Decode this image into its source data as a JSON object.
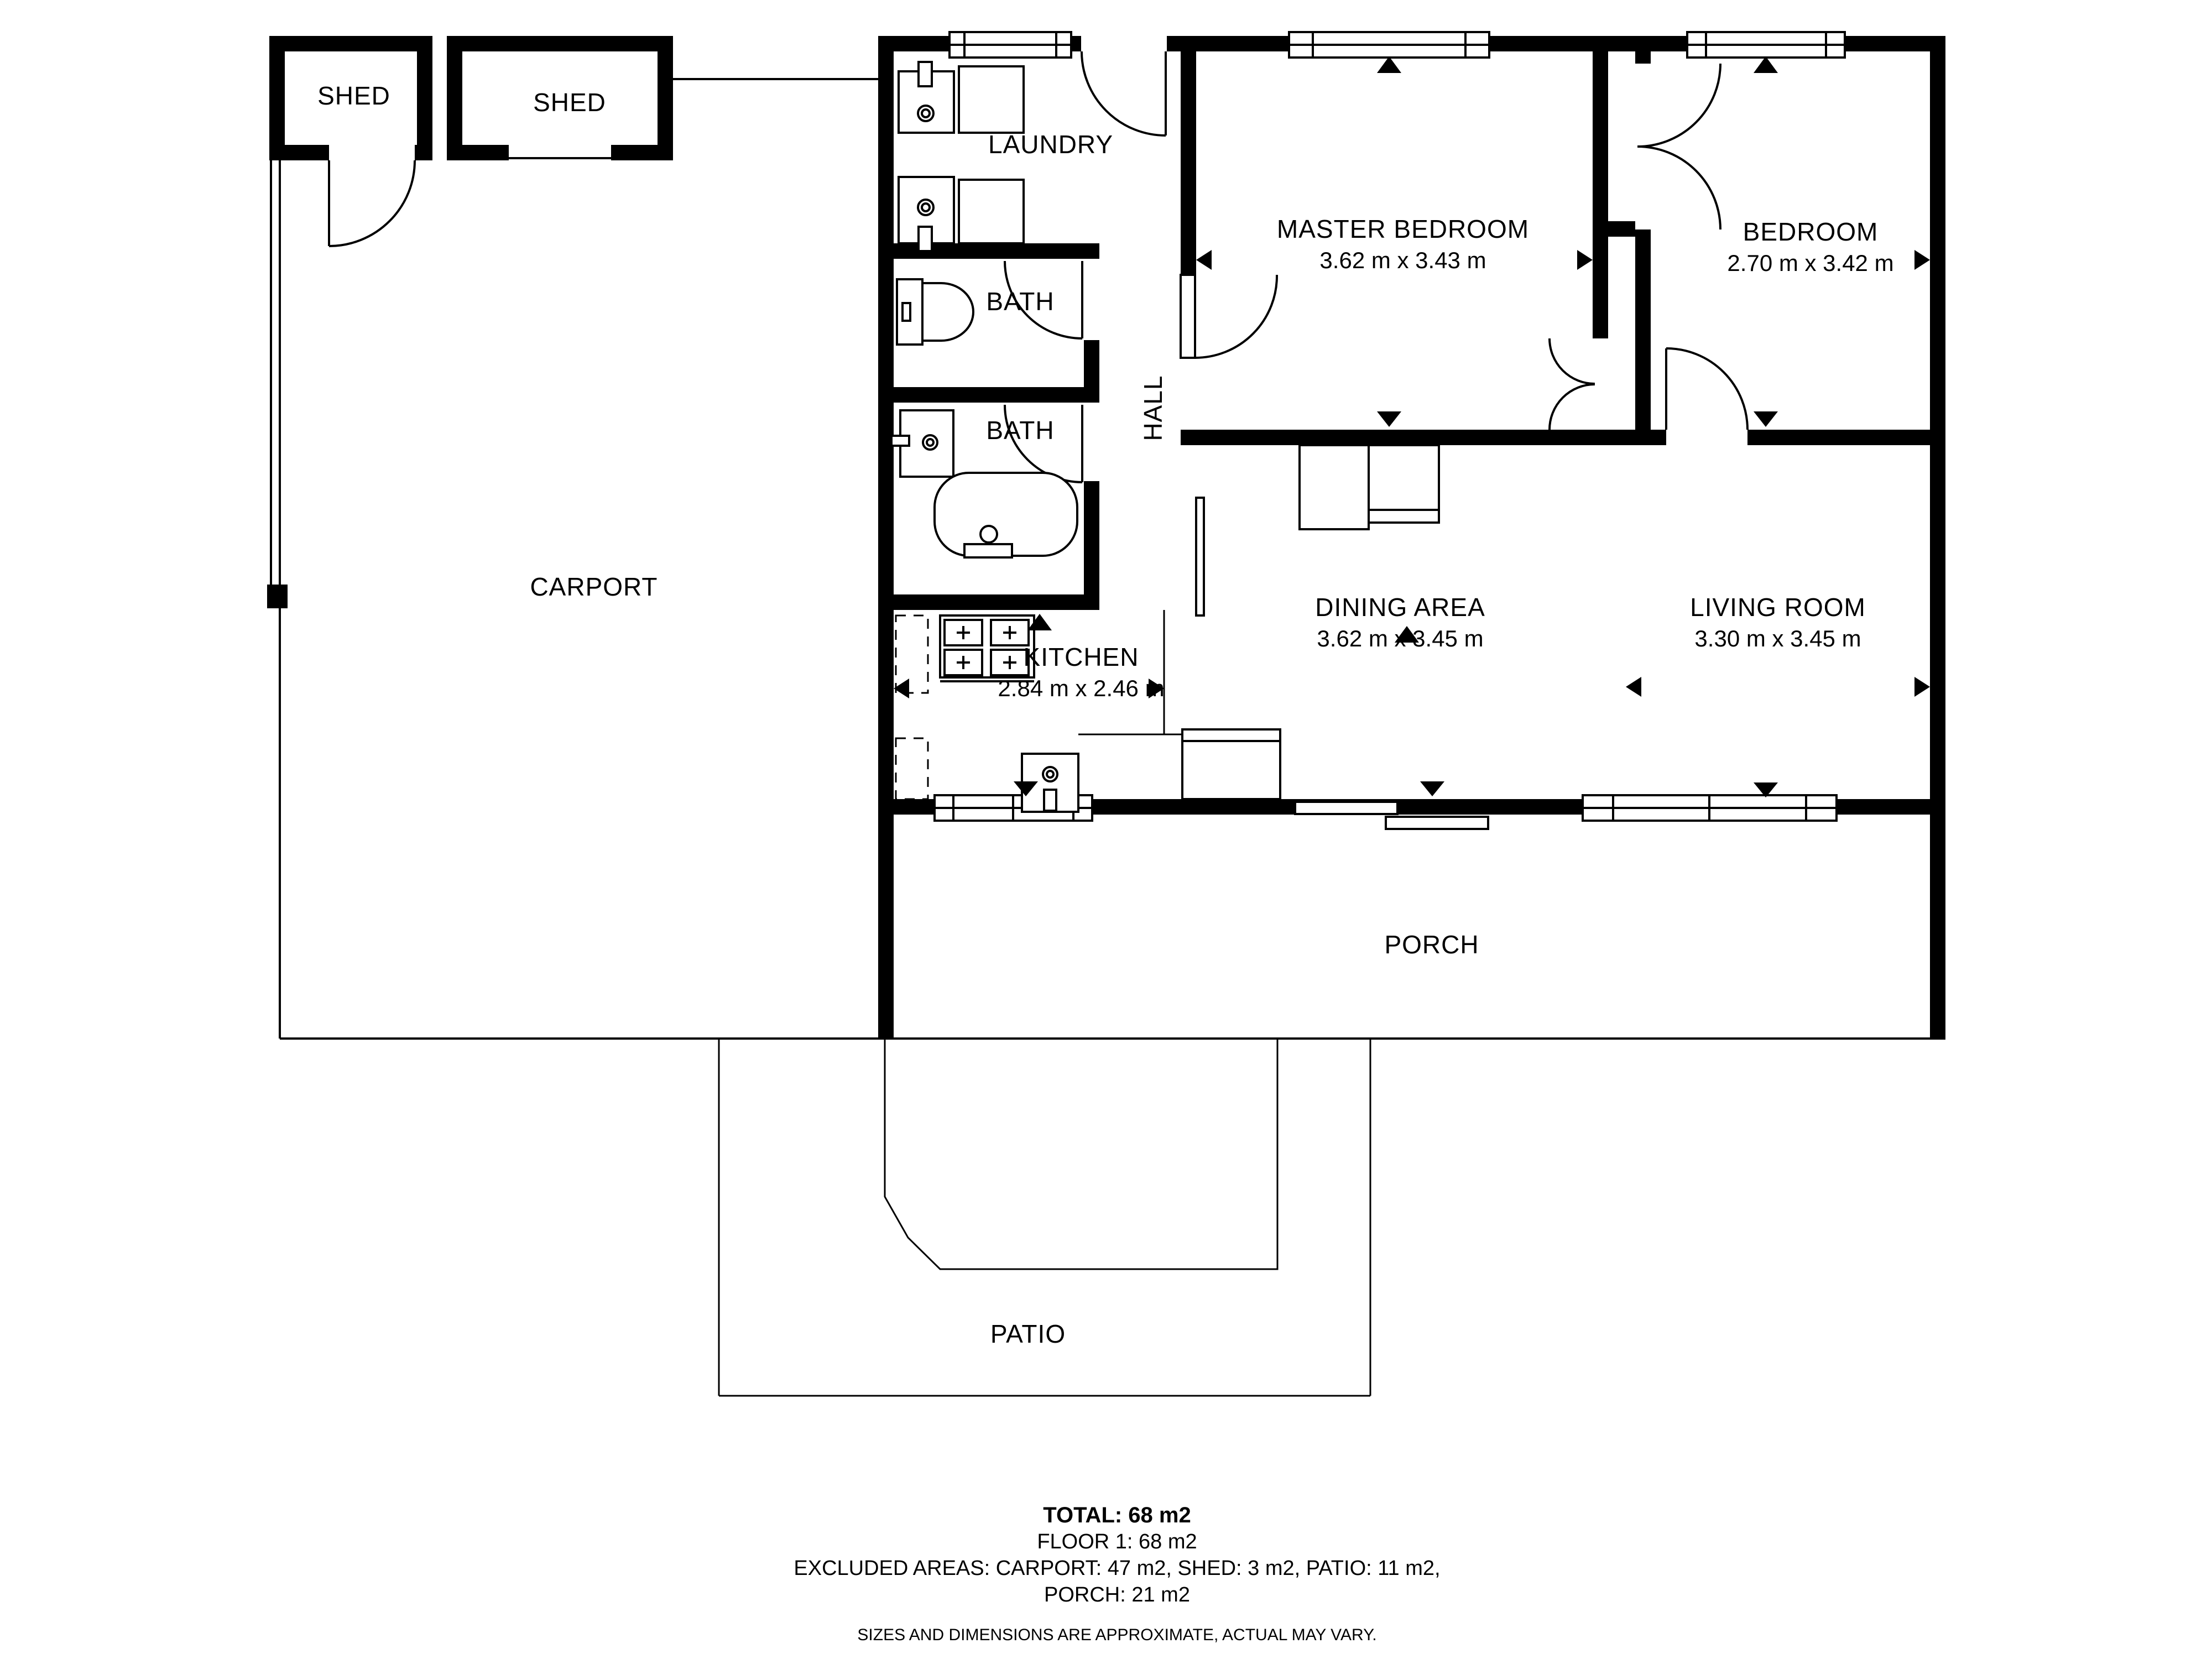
{
  "plan": {
    "title": "Floor plan - Floor 1",
    "rooms": {
      "shed1": {
        "label": "SHED"
      },
      "shed2": {
        "label": "SHED"
      },
      "carport": {
        "label": "CARPORT"
      },
      "laundry": {
        "label": "LAUNDRY"
      },
      "bath1": {
        "label": "BATH"
      },
      "bath2": {
        "label": "BATH"
      },
      "hall": {
        "label": "HALL"
      },
      "master_bedroom": {
        "label": "MASTER BEDROOM",
        "dimensions": "3.62 m x 3.43 m"
      },
      "bedroom": {
        "label": "BEDROOM",
        "dimensions": "2.70 m x 3.42 m"
      },
      "kitchen": {
        "label": "KITCHEN",
        "dimensions": "2.84 m x 2.46 m"
      },
      "dining_area": {
        "label": "DINING AREA",
        "dimensions": "3.62 m x 3.45 m"
      },
      "living_room": {
        "label": "LIVING ROOM",
        "dimensions": "3.30 m x 3.45 m"
      },
      "porch": {
        "label": "PORCH"
      },
      "patio": {
        "label": "PATIO"
      }
    },
    "summary": {
      "total": "TOTAL: 68 m2",
      "floor": "FLOOR 1: 68 m2",
      "excluded_line1": "EXCLUDED AREAS: CARPORT: 47 m2, SHED: 3 m2, PATIO: 11 m2,",
      "excluded_line2": "PORCH: 21 m2",
      "disclaimer": "SIZES AND DIMENSIONS ARE APPROXIMATE, ACTUAL MAY VARY."
    },
    "colors": {
      "wall": "#000000",
      "background": "#ffffff",
      "text": "#000000"
    }
  }
}
